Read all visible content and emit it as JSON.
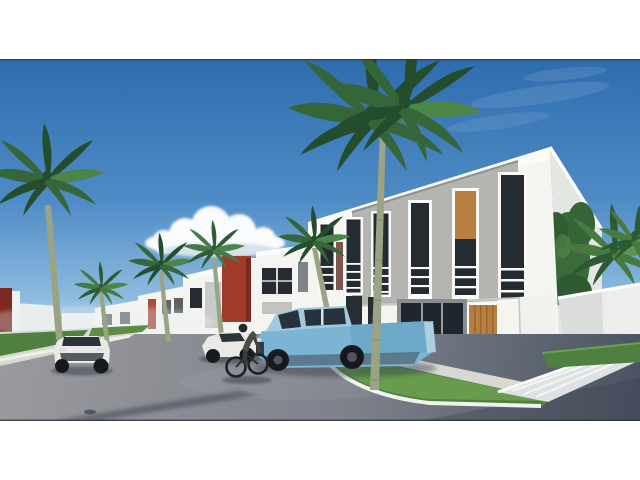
{
  "scene": {
    "type": "3d-architectural-rendering",
    "description": "3D architectural rendering of a modern residential street: a row of two-storey white townhouses with grey window panels, red accent columns and wooden doors, lined with royal palm trees; a light blue pickup truck, a white sports car, a white convertible and a cyclist are on the grey street under a blue sky with a white cloud; a white perimeter wall, a date palm and a conifer stand at the right.",
    "objects": [
      "sky",
      "cloud",
      "distant-buildings",
      "townhouse-row",
      "red-accent-column",
      "main-townhouse",
      "upper-windows-with-railings",
      "storefront-window",
      "wooden-door",
      "gable-side-wall",
      "perimeter-wall",
      "conifer-tree",
      "date-palm",
      "royal-palm-row",
      "foreground-palm",
      "grass-island",
      "left-sidewalk",
      "street",
      "driveway",
      "pickup-truck",
      "sports-car",
      "convertible-car",
      "cyclist"
    ]
  },
  "colors": {
    "sky_top": "#2e6cae",
    "sky_mid": "#4f8cc6",
    "sky_low": "#8fbcde",
    "sky_horizon": "#c3dcee",
    "cloud": "#f9fbfd",
    "building_white": "#f4f4f0",
    "building_side": "#e4e6e3",
    "building_grey_panel": "#b4b5b1",
    "frame_white": "#fafaf8",
    "glass_dark": "#242b31",
    "accent_red": "#a03a2b",
    "accent_red_dark": "#7c2a20",
    "wood": "#b97f3e",
    "wall_white": "#edeeec",
    "concrete": "#d8d8d2",
    "grass": "#4f8040",
    "grass_light": "#74aa55",
    "road_light": "#9a9a9e",
    "road_mid": "#7d818a",
    "road_dark": "#4a5361",
    "truck_blue": "#7cb4d3",
    "truck_blue_light": "#9fcbe0",
    "truck_glass": "#26333d",
    "car_white": "#e9eae6",
    "trunk_green": "#9aa383",
    "trunk_brown": "#8a7358",
    "palm_dark": "#234d2c",
    "palm_mid": "#35663a",
    "palm_light": "#4b8547",
    "shadow": "#323b47"
  }
}
